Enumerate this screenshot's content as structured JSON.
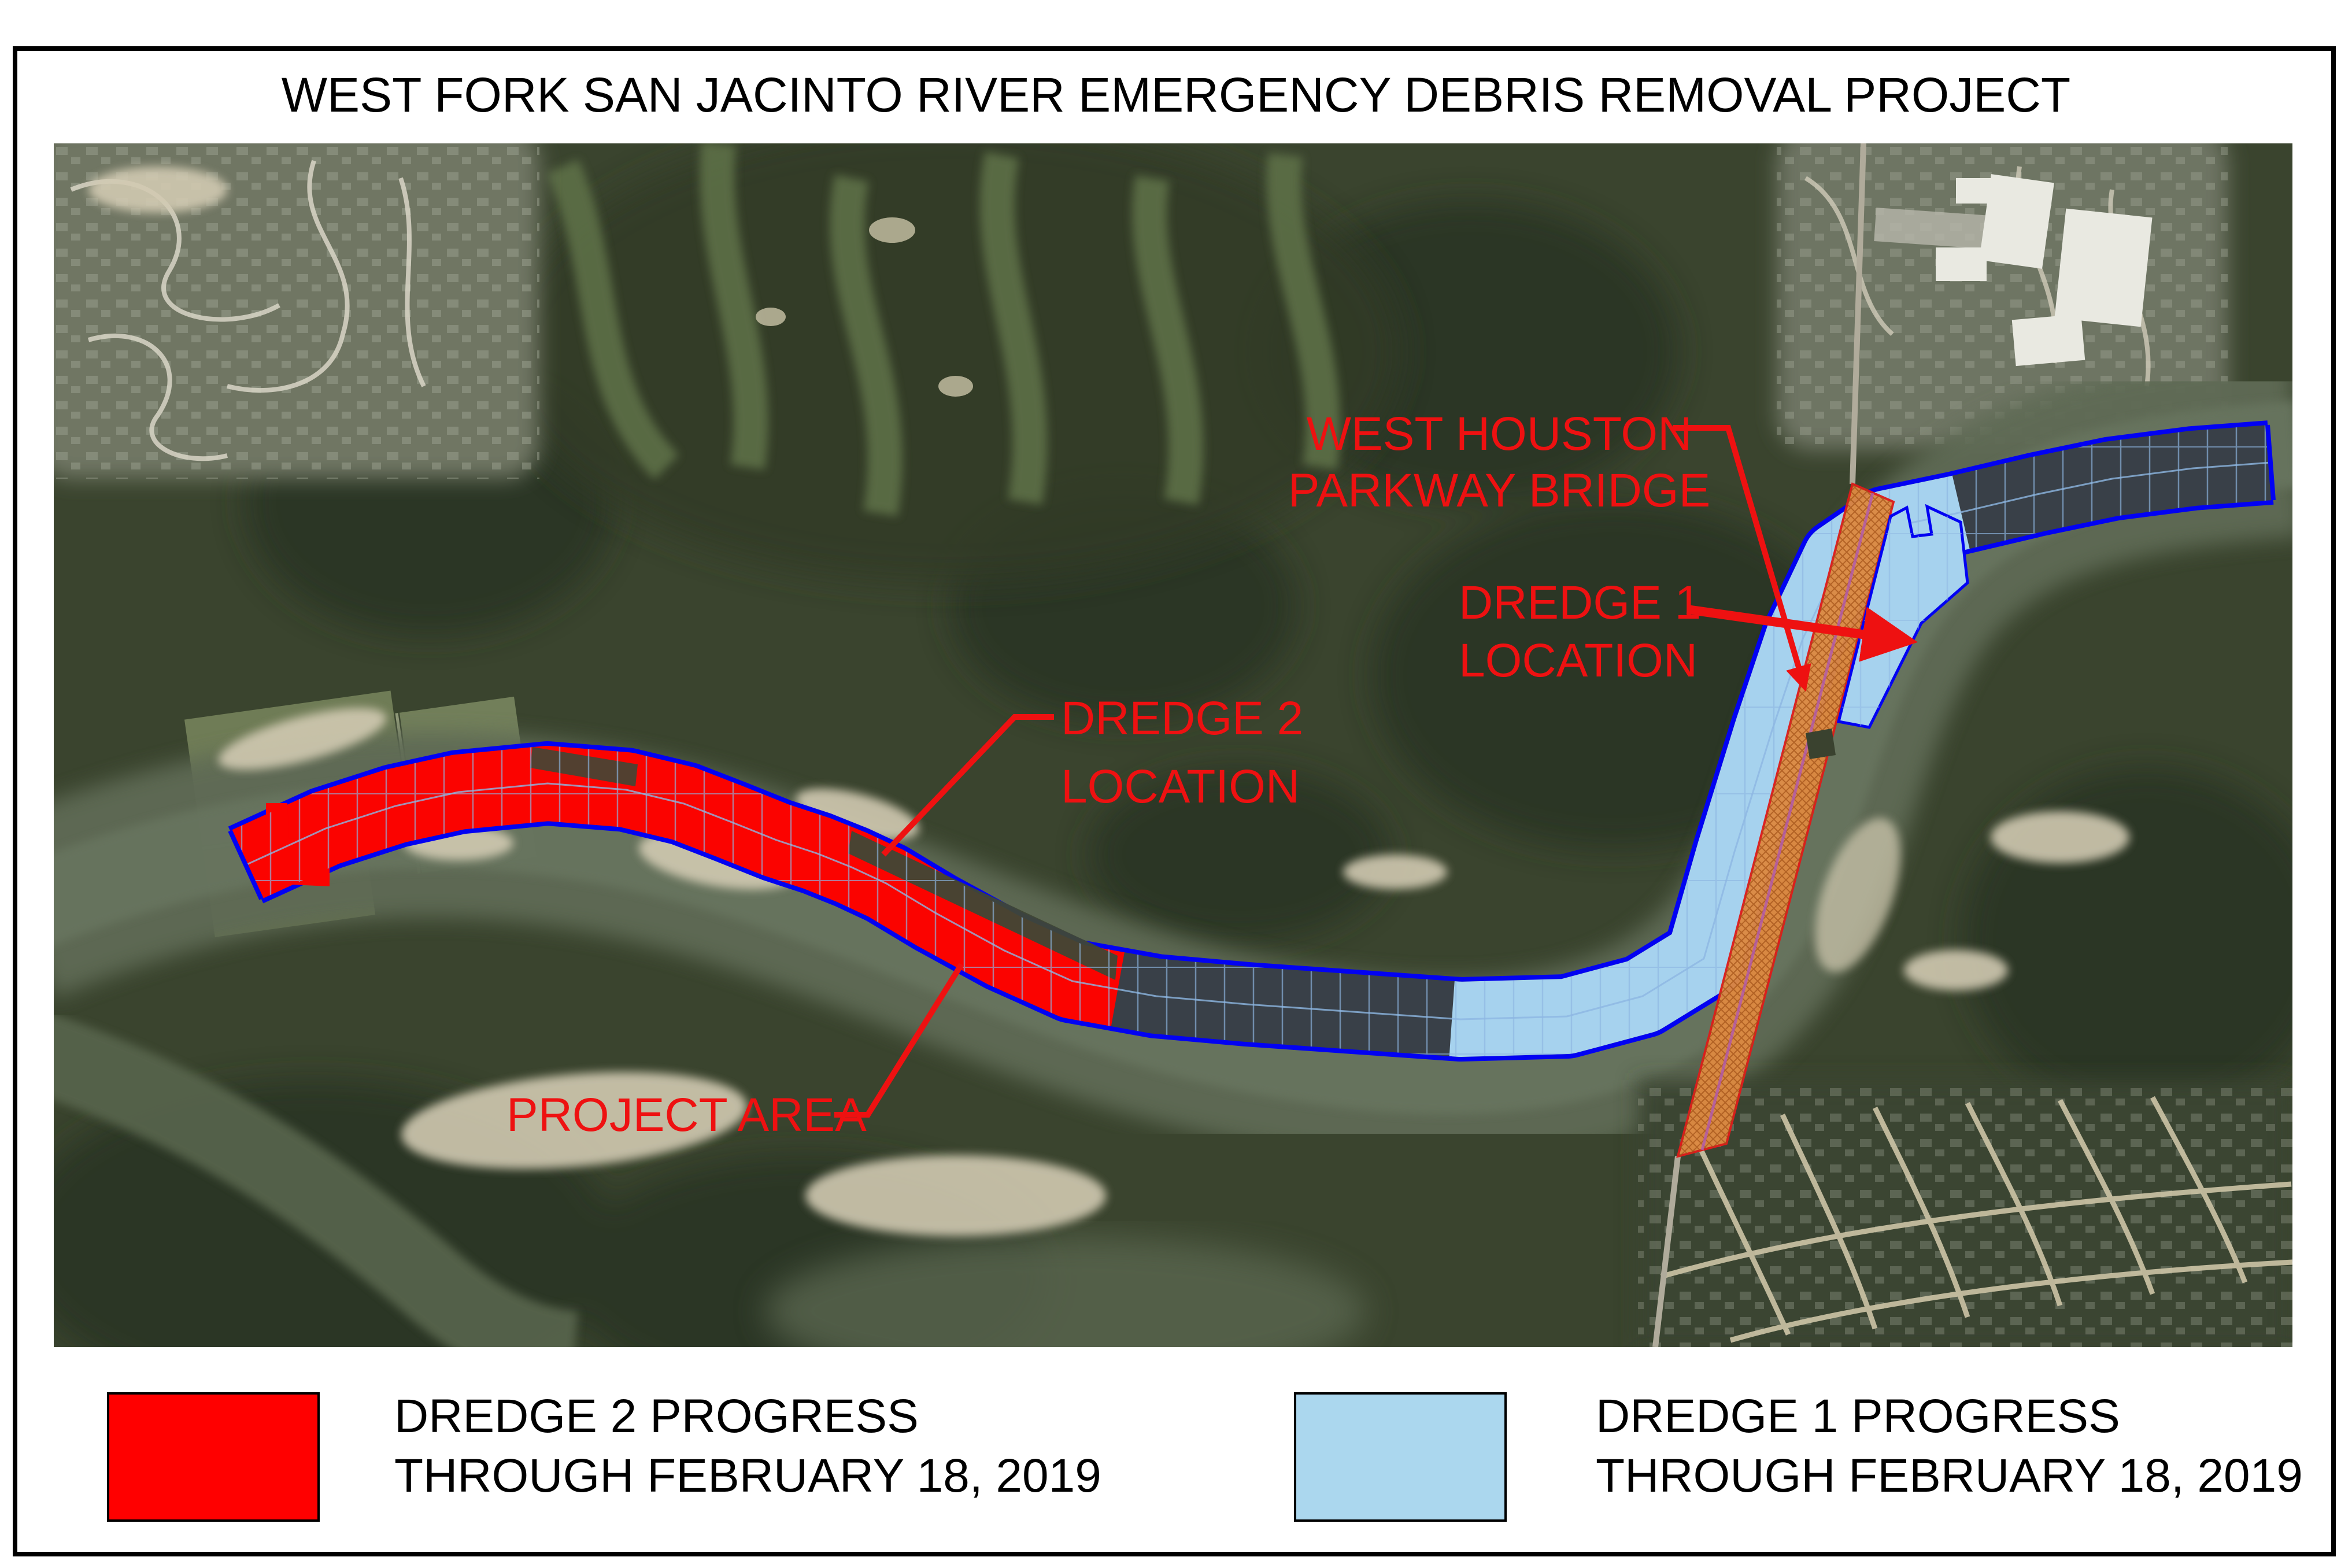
{
  "title": "WEST FORK SAN JACINTO RIVER EMERGENCY DEBRIS REMOVAL PROJECT",
  "map": {
    "annotations": {
      "bridge_label": {
        "line1": "WEST HOUSTON",
        "line2": "PARKWAY BRIDGE"
      },
      "dredge1_label": {
        "line1": "DREDGE 1",
        "line2": "LOCATION"
      },
      "dredge2_label": {
        "line1": "DREDGE 2",
        "line2": "LOCATION"
      },
      "project_area_label": "PROJECT AREA"
    }
  },
  "legend": {
    "dredge2": {
      "title": "DREDGE 2 PROGRESS",
      "subtitle": "THROUGH FEBRUARY 18, 2019",
      "color": "#ff0000"
    },
    "dredge1": {
      "title": "DREDGE 1 PROGRESS",
      "subtitle": "THROUGH FEBRUARY 18, 2019",
      "color": "#abd7ee"
    }
  },
  "colors": {
    "annotation_red": "#ee1111",
    "dredge2_fill": "#fb0300",
    "dredge1_fill": "#a6d2ee",
    "channel_outline": "#0202f2",
    "pending_fill": "#3f4735",
    "bridge_fill": "#dd8a42",
    "bridge_outline": "#e01b1b",
    "transect_blue": "#8db6e2"
  }
}
